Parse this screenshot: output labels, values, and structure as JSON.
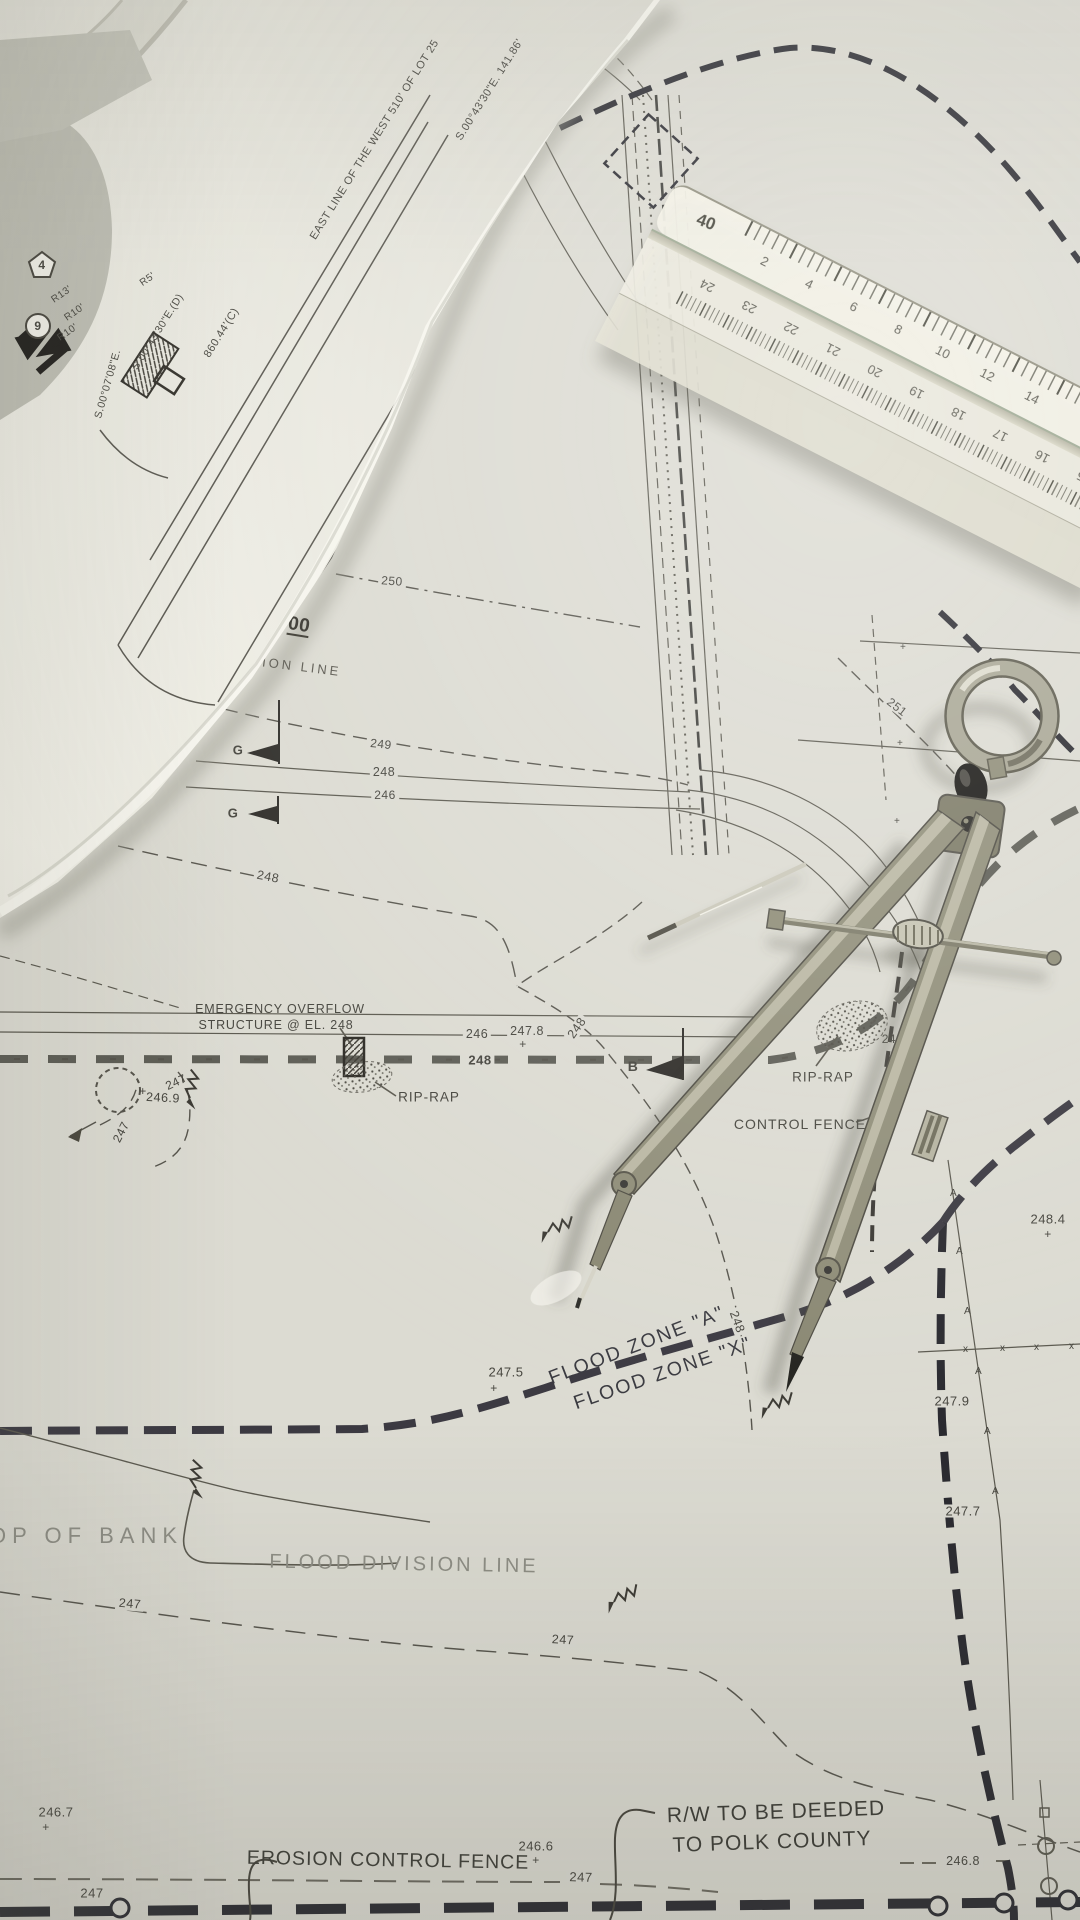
{
  "scene": {
    "description": "Photograph of rolled and flat civil-engineering site blueprints with a drafting compass, a loose divider needle and a triangular architect scale ruler"
  },
  "palette": {
    "paper": "#dcdbd2",
    "roll_paper": "#e9e8df",
    "ink": "#55534b",
    "ink_heavy": "#34343a",
    "ink_black": "#26262b",
    "text_dark": "#3e3e38",
    "text_gray": "#8d8d84",
    "compass_metal": "#8e8c77",
    "compass_knob": "#1d1b18",
    "ruler_body": "#efede0"
  },
  "plan": {
    "labels": {
      "emergency_line1": "EMERGENCY OVERFLOW",
      "emergency_line2": "STRUCTURE @ EL. 248",
      "rip_rap": "RIP-RAP",
      "control_fence": "CONTROL FENCE",
      "flood_zone_a": "FLOOD ZONE \"A\"",
      "flood_zone_x": "FLOOD ZONE \"X\"",
      "flood_division_line": "FLOOD DIVISION LINE",
      "top_of_bank": "OP OF BANK",
      "erosion_control_fence": "EROSION CONTROL FENCE",
      "rw_line1": "R/W TO BE DEEDED",
      "rw_line2": "TO POLK COUNTY",
      "division_line_partial": "SION LINE",
      "station": "00"
    },
    "contours": {
      "c246": "246",
      "c247": "247",
      "c248": "248",
      "c249": "249",
      "c250": "250",
      "c251": "251"
    },
    "elevations": {
      "plus": "+",
      "e247_8": "247.8",
      "e246_9": "246.9",
      "e247_5": "247.5",
      "e248_4": "248.4",
      "e248_2": "248.2",
      "e247_9": "247.9",
      "e247_7": "247.7",
      "e246_6": "246.6",
      "e246_7": "246.7",
      "e246_8": "246.8"
    },
    "markers": {
      "section_b": "B",
      "section_g": "G",
      "key_4": "4",
      "key_9": "9",
      "fence_x": "x",
      "fence_a": "A"
    },
    "survey": {
      "east_line": "EAST LINE OF THE WEST 510' OF LOT 25",
      "bearing_main": "S.00°43'30\"E.  141.86'",
      "bearing_deed": "S.00°43'30\"E.(D)",
      "distance_calc": "860.44'(C)",
      "bearing_side": "S.00°07'08\"E.",
      "radius_13": "R13'",
      "radius_10a": "R10'",
      "radius_10b": "R10'",
      "radius_5": "R5'"
    }
  },
  "ruler": {
    "scale_label": "40",
    "top_numbers": [
      "2",
      "4",
      "6",
      "8",
      "10",
      "12",
      "14"
    ],
    "bottom_numbers": [
      "24",
      "23",
      "22",
      "21",
      "20",
      "19",
      "18",
      "17",
      "16",
      "15"
    ]
  }
}
